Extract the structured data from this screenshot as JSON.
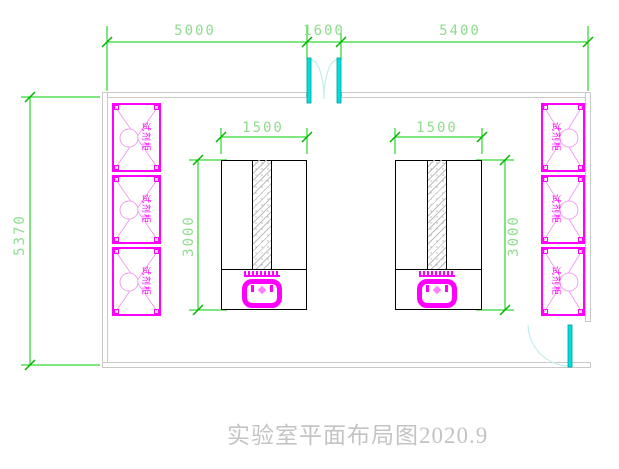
{
  "drawing": {
    "title": "实验室平面布局图2020.9",
    "dims": {
      "top_left": "5000",
      "top_door": "1600",
      "top_right": "5400",
      "room_depth": "5370",
      "bench_width": "1500",
      "bench_depth": "3000"
    },
    "cabinet_label": "试剂柜",
    "colors": {
      "dimension_green": "#00cf00",
      "dimension_text_green": "#8fdc8f",
      "cabinet_magenta": "#ff00ff",
      "cabinet_magenta_light": "#f08cf0",
      "door_cyan": "#00dede",
      "door_arc_cyan": "#c2eeee",
      "wall_gray": "#c9c9c9",
      "bench_black": "#000000",
      "title_gray": "#c4c4c4"
    }
  }
}
